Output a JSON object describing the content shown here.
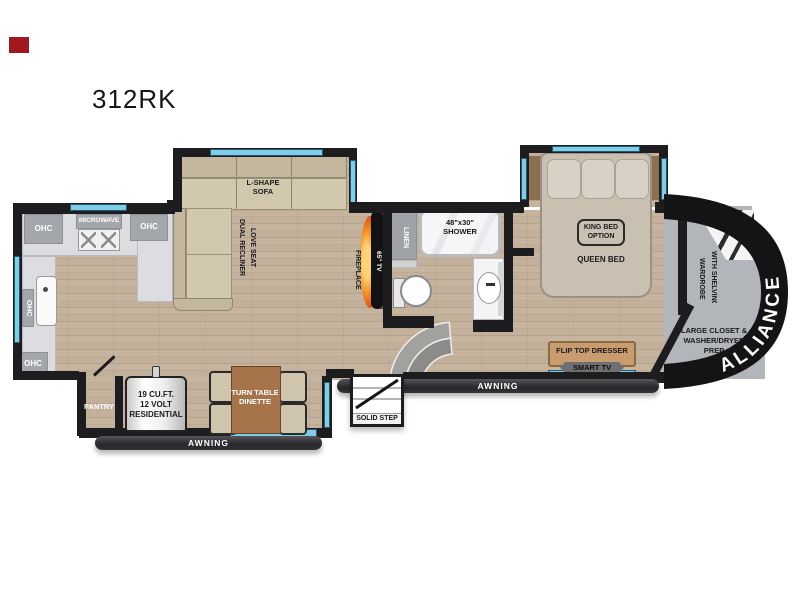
{
  "title": "312RK",
  "colors": {
    "wall": "#1d1d1f",
    "window_blue": "#7ecde9",
    "floor_wood": "#c2b09b",
    "counter_gray": "#dcdde0",
    "cabinet_gray": "#a3a7ab",
    "area_gray": "#b2b6ba",
    "awning_dark": "#2e2e31",
    "flame_orange": "#f07818",
    "table_wood": "#a5744a",
    "dresser_tan": "#c99c6f",
    "accent_red": "#a1191d"
  },
  "kitchen": {
    "ohc": "OHC",
    "microwave": "MICROWAVE"
  },
  "living": {
    "sofa1": "L-SHAPE",
    "sofa2": "SOFA",
    "loveseat1": "DUAL RECLINER",
    "loveseat2": "LOVE SEAT",
    "fireplace": "FIREPLACE",
    "tv": "65\" TV"
  },
  "bath": {
    "linen": "LINEN",
    "shower1": "48\"x30\"",
    "shower2": "SHOWER"
  },
  "bedroom": {
    "king1": "KING BED",
    "king2": "OPTION",
    "queen": "QUEEN BED",
    "dresser": "FLIP TOP DRESSER",
    "smarttv": "SMART TV",
    "wardrobe1": "WARDROBE",
    "wardrobe2": "WITH SHELVING"
  },
  "front": {
    "closet1": "LARGE CLOSET &",
    "closet2": "WASHER/DRYER",
    "closet3": "PREP",
    "brand": "ALLIANCE"
  },
  "galley": {
    "pantry": "PANTRY",
    "fridge1": "19 CU.FT.",
    "fridge2": "12 VOLT",
    "fridge3": "RESIDENTIAL",
    "dinette1": "TURN TABLE",
    "dinette2": "DINETTE"
  },
  "exterior": {
    "awning": "AWNING",
    "solid_step": "SOLID STEP"
  }
}
